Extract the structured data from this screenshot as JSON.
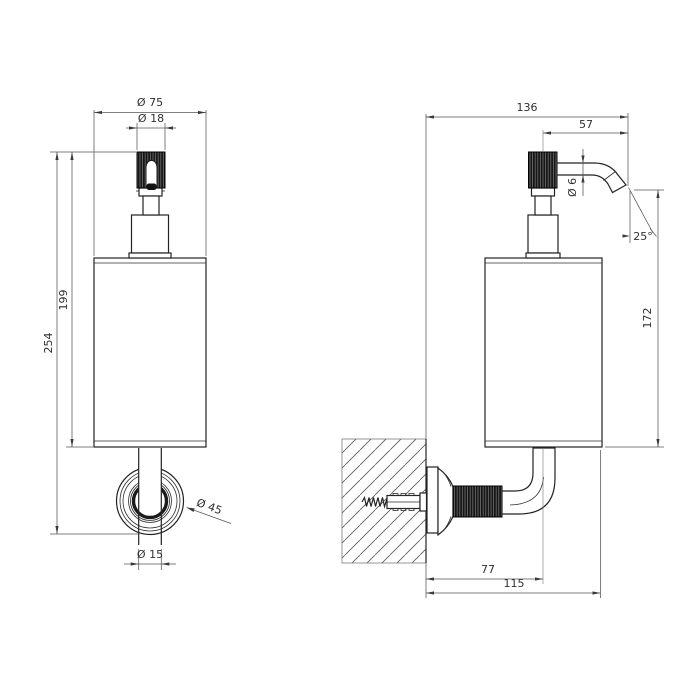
{
  "drawing": {
    "background_color": "#ffffff",
    "object_line_color": "#232323",
    "dimension_line_color": "#555555",
    "views": {
      "front": {
        "dims": {
          "body_diameter": "Ø 75",
          "pump_knob_diameter": "Ø 18",
          "overall_height": "254",
          "body_height": "199",
          "wall_flange_diameter": "Ø 45",
          "supply_tube_diameter": "Ø 15"
        }
      },
      "side": {
        "dims": {
          "overall_depth": "136",
          "spout_projection": "57",
          "spout_tube_diameter": "Ø 6",
          "spout_angle": "25°",
          "spout_to_base_height": "172",
          "wall_to_riser_axis": "77",
          "wall_to_body_front": "115"
        }
      }
    }
  }
}
